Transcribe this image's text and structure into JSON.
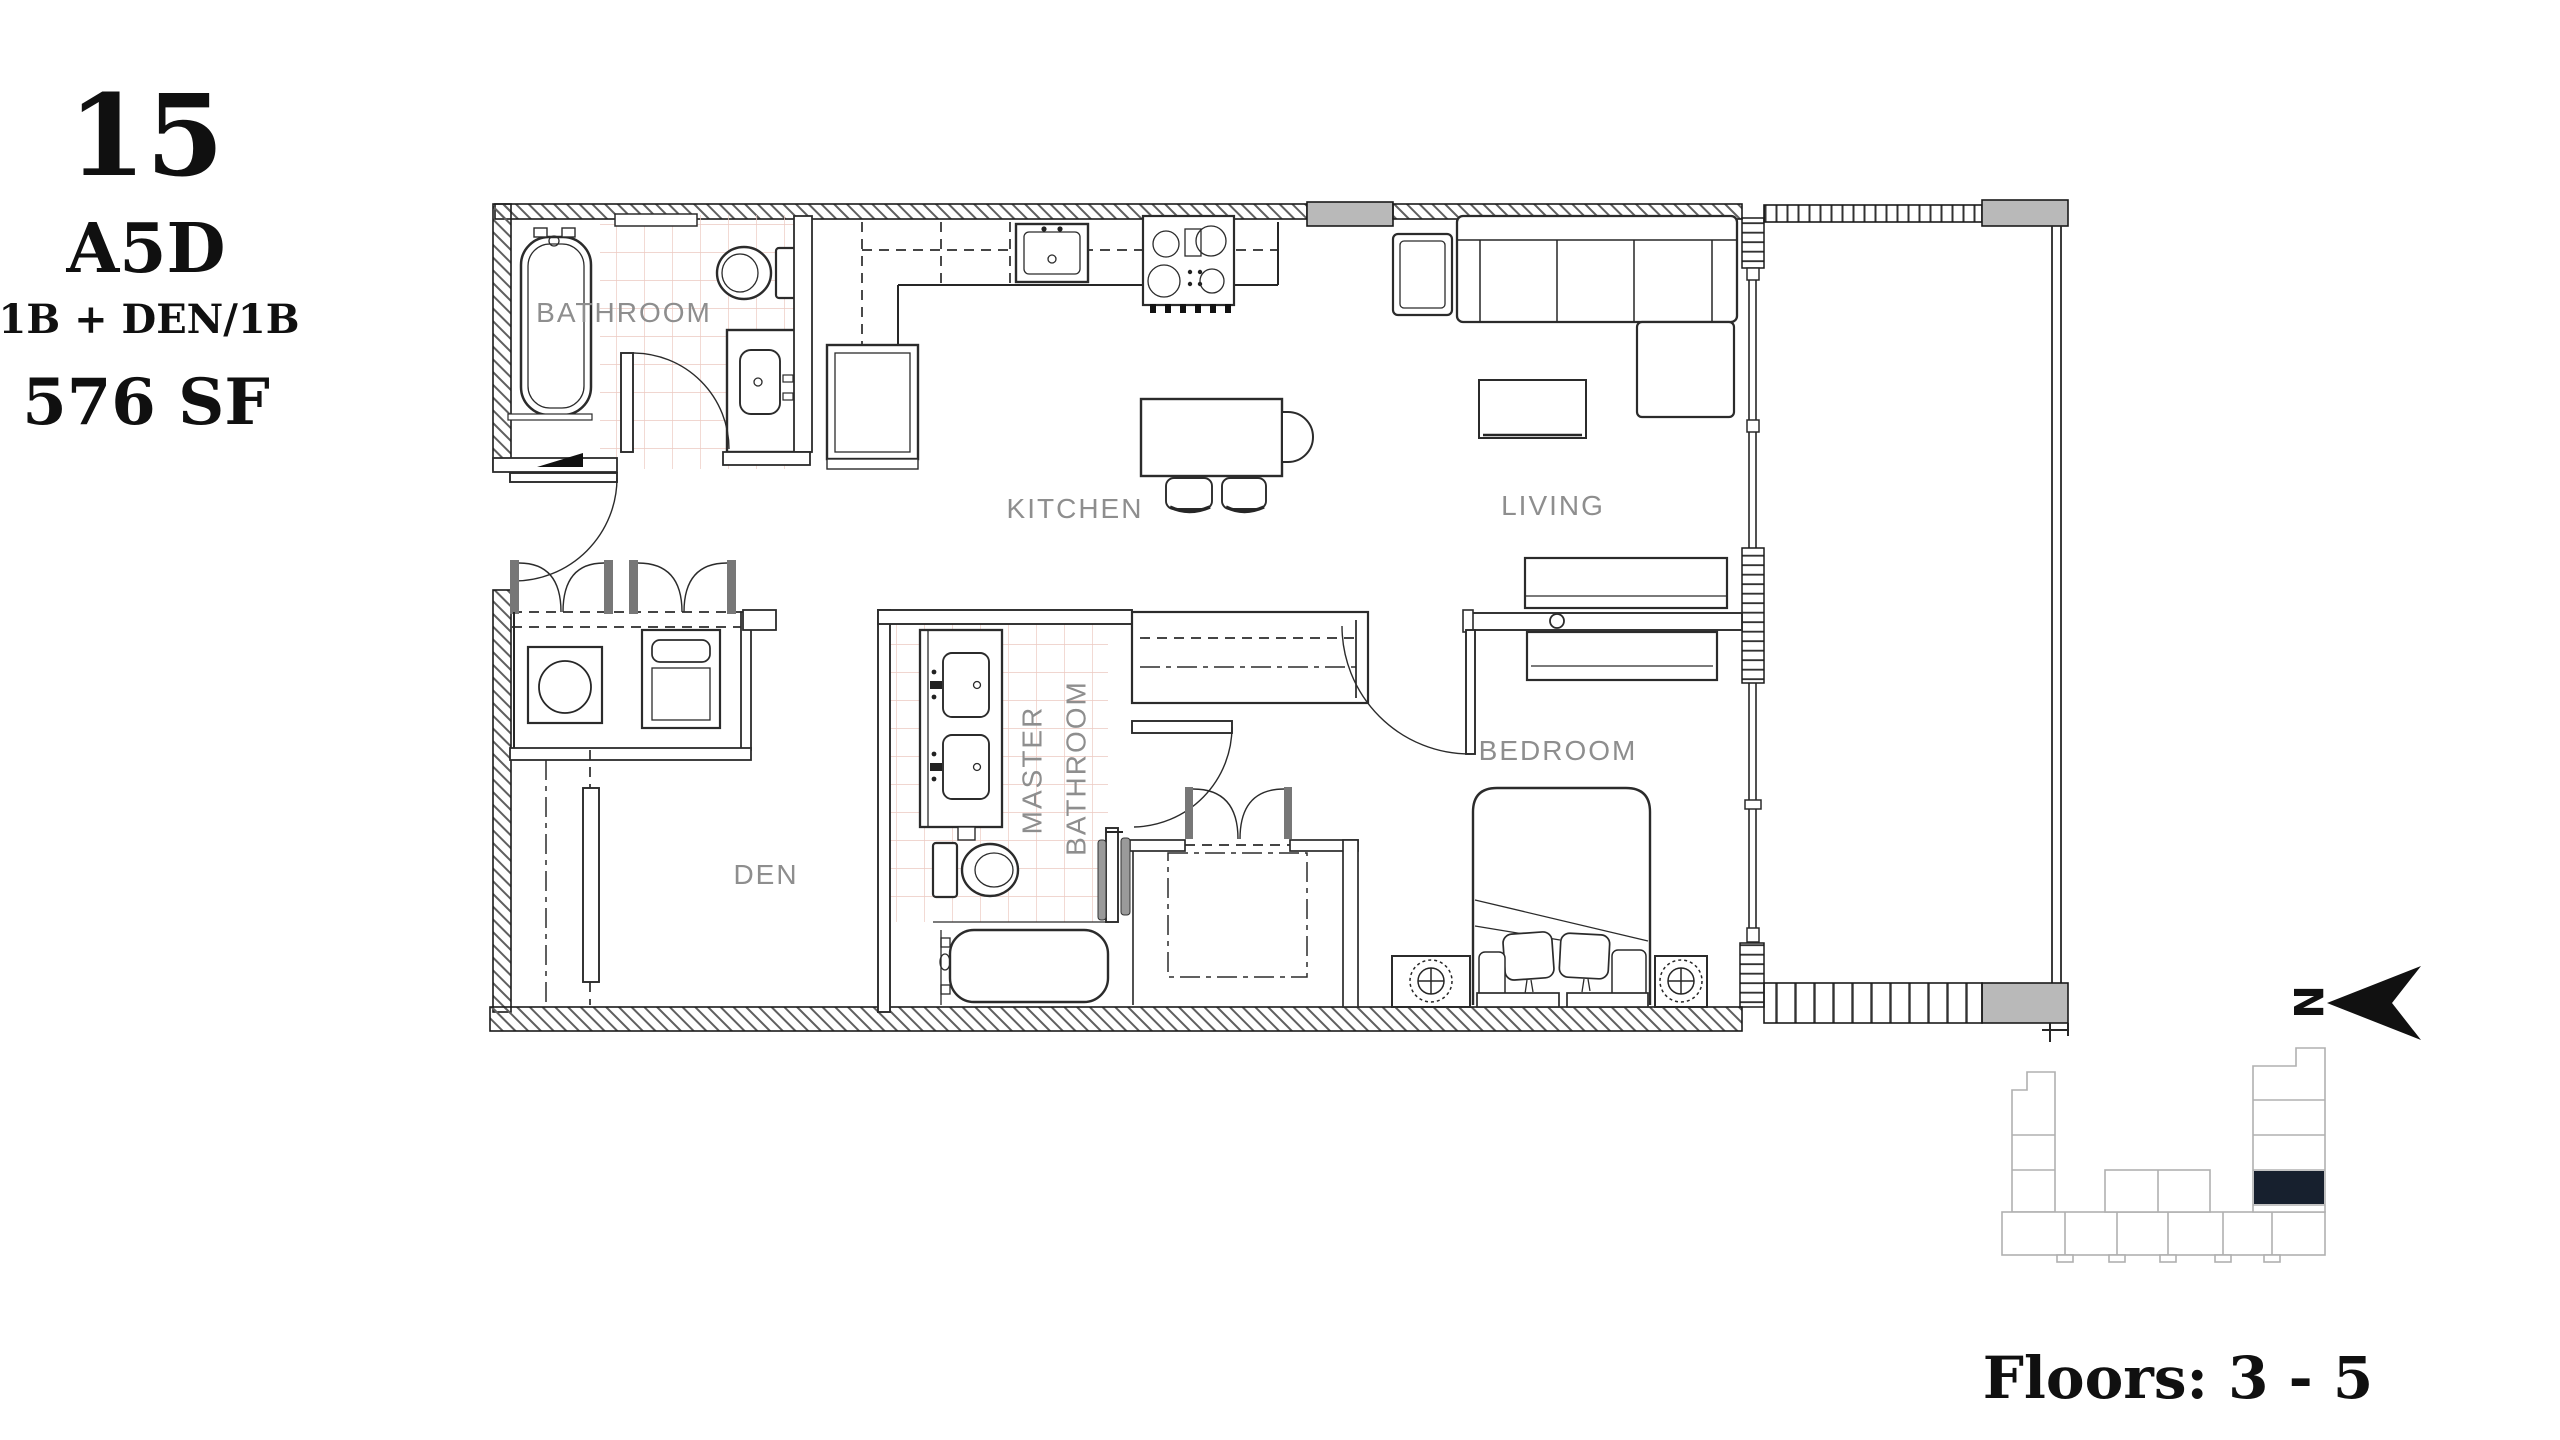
{
  "unit": {
    "number": "15",
    "plan_code": "A5D",
    "plan_type": "1B + DEN/1B",
    "area": "576 SF"
  },
  "rooms": {
    "bathroom": "BATHROOM",
    "kitchen": "KITCHEN",
    "living": "LIVING",
    "den": "DEN",
    "master_bathroom_line1": "MASTER",
    "master_bathroom_line2": "BATHROOM",
    "bedroom": "BEDROOM"
  },
  "compass": {
    "north": "N"
  },
  "keyplan": {
    "floors": "Floors: 3 - 5"
  },
  "colors": {
    "unit_highlight": "#17202e",
    "tile_line": "#ecc9c1",
    "wall_gray": "#b9b9b9",
    "label_gray": "#8e8e8e"
  }
}
